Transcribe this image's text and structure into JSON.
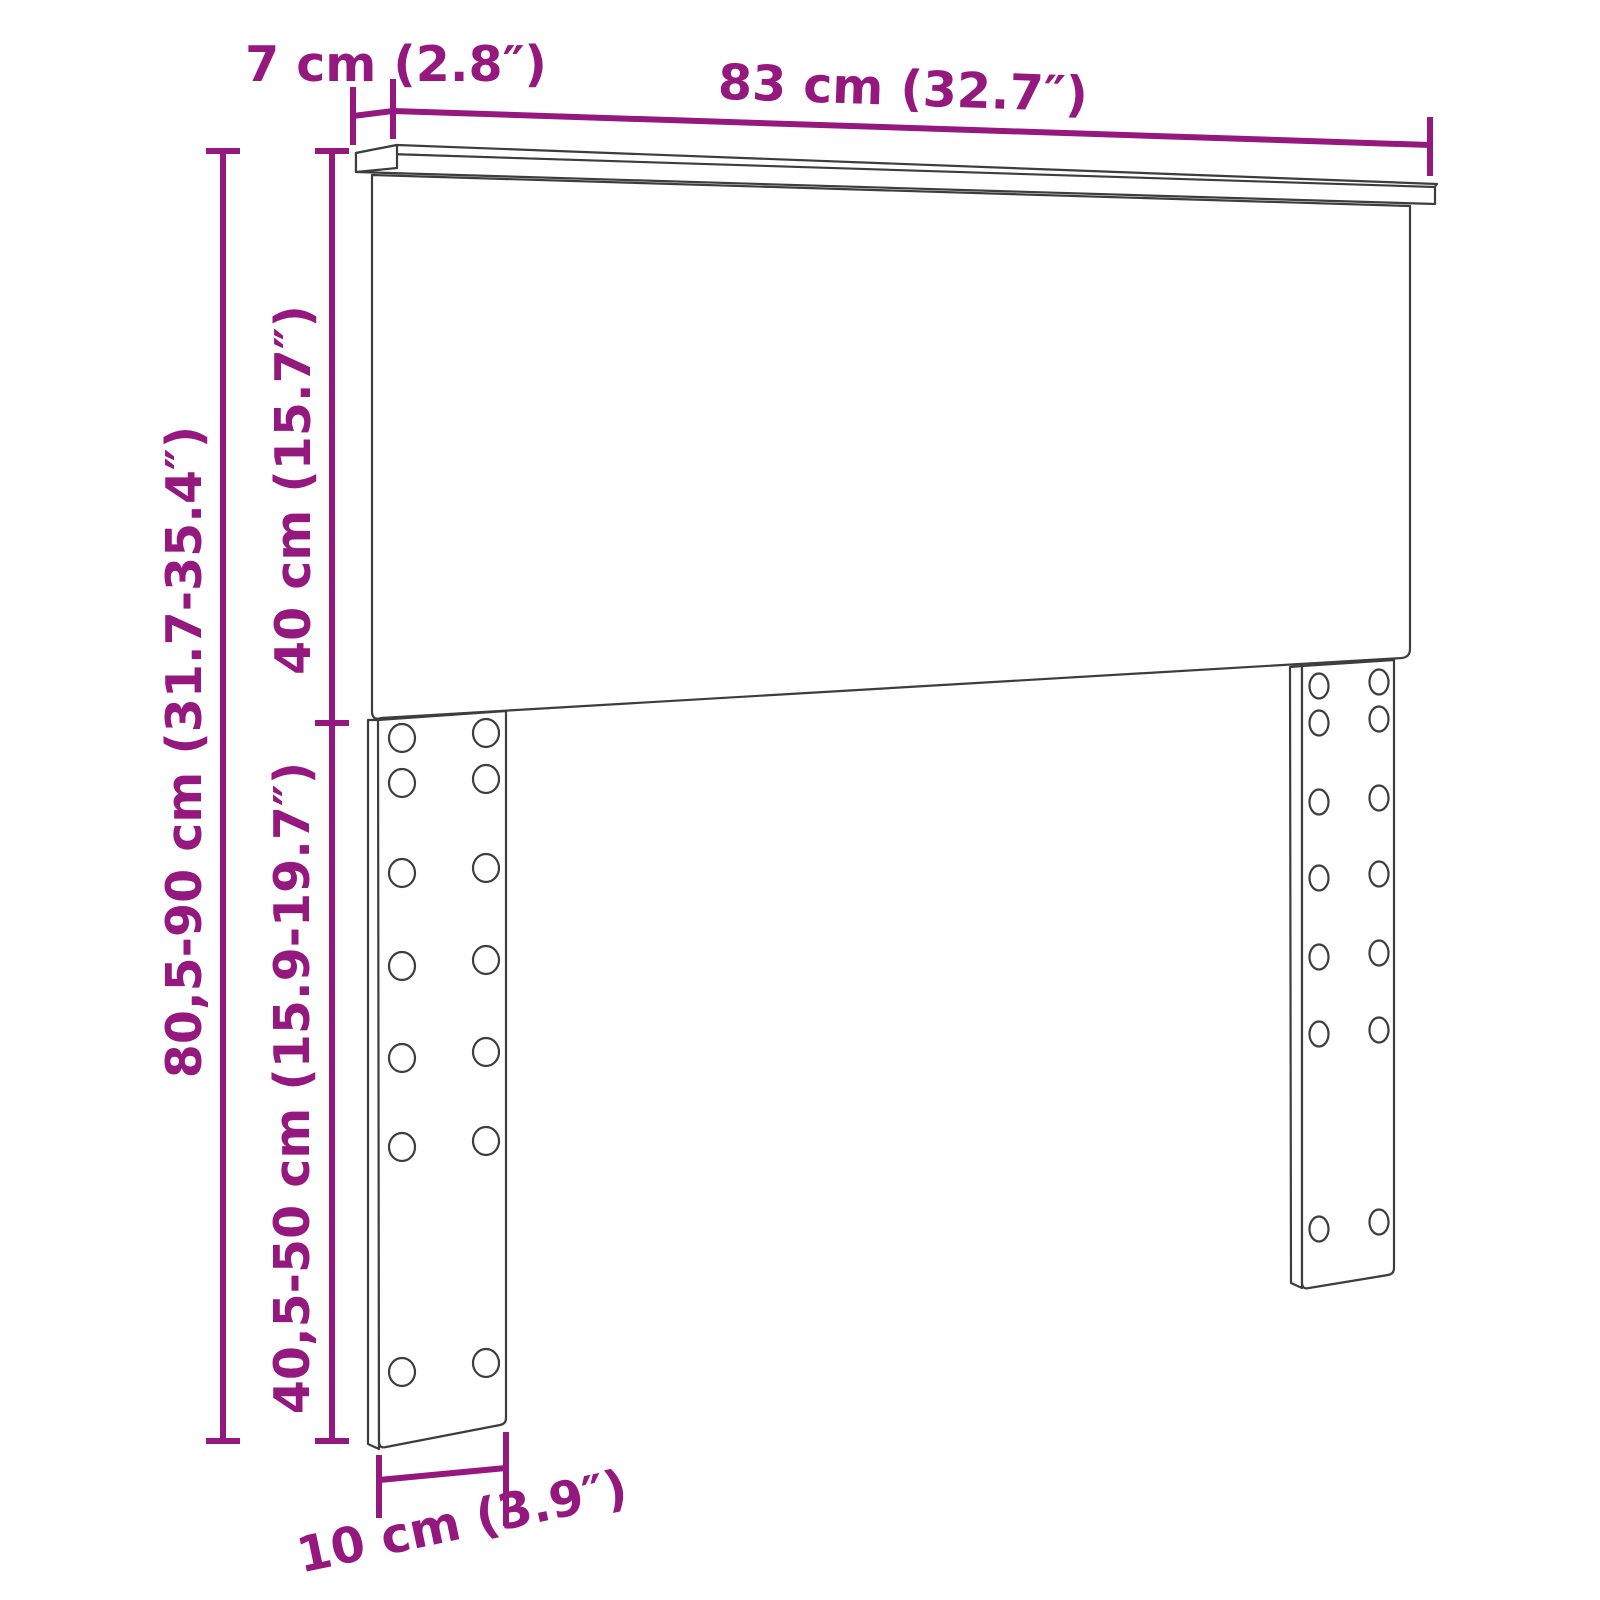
{
  "diagram": {
    "type": "product-dimension-drawing",
    "subject": "headboard-with-adjustable-legs",
    "labels": {
      "top_depth": "7 cm (2.8″)",
      "width": "83 cm (32.7″)",
      "panel_height": "40 cm (15.7″)",
      "total_height": "80,5-90 cm (31.7-35.4″)",
      "leg_height": "40,5-50 cm (15.9-19.7″)",
      "leg_width": "10 cm (3.9″)"
    },
    "colors": {
      "dimension": "#94187E",
      "outline": "#3D3D3D",
      "background": "#FFFFFF"
    }
  }
}
